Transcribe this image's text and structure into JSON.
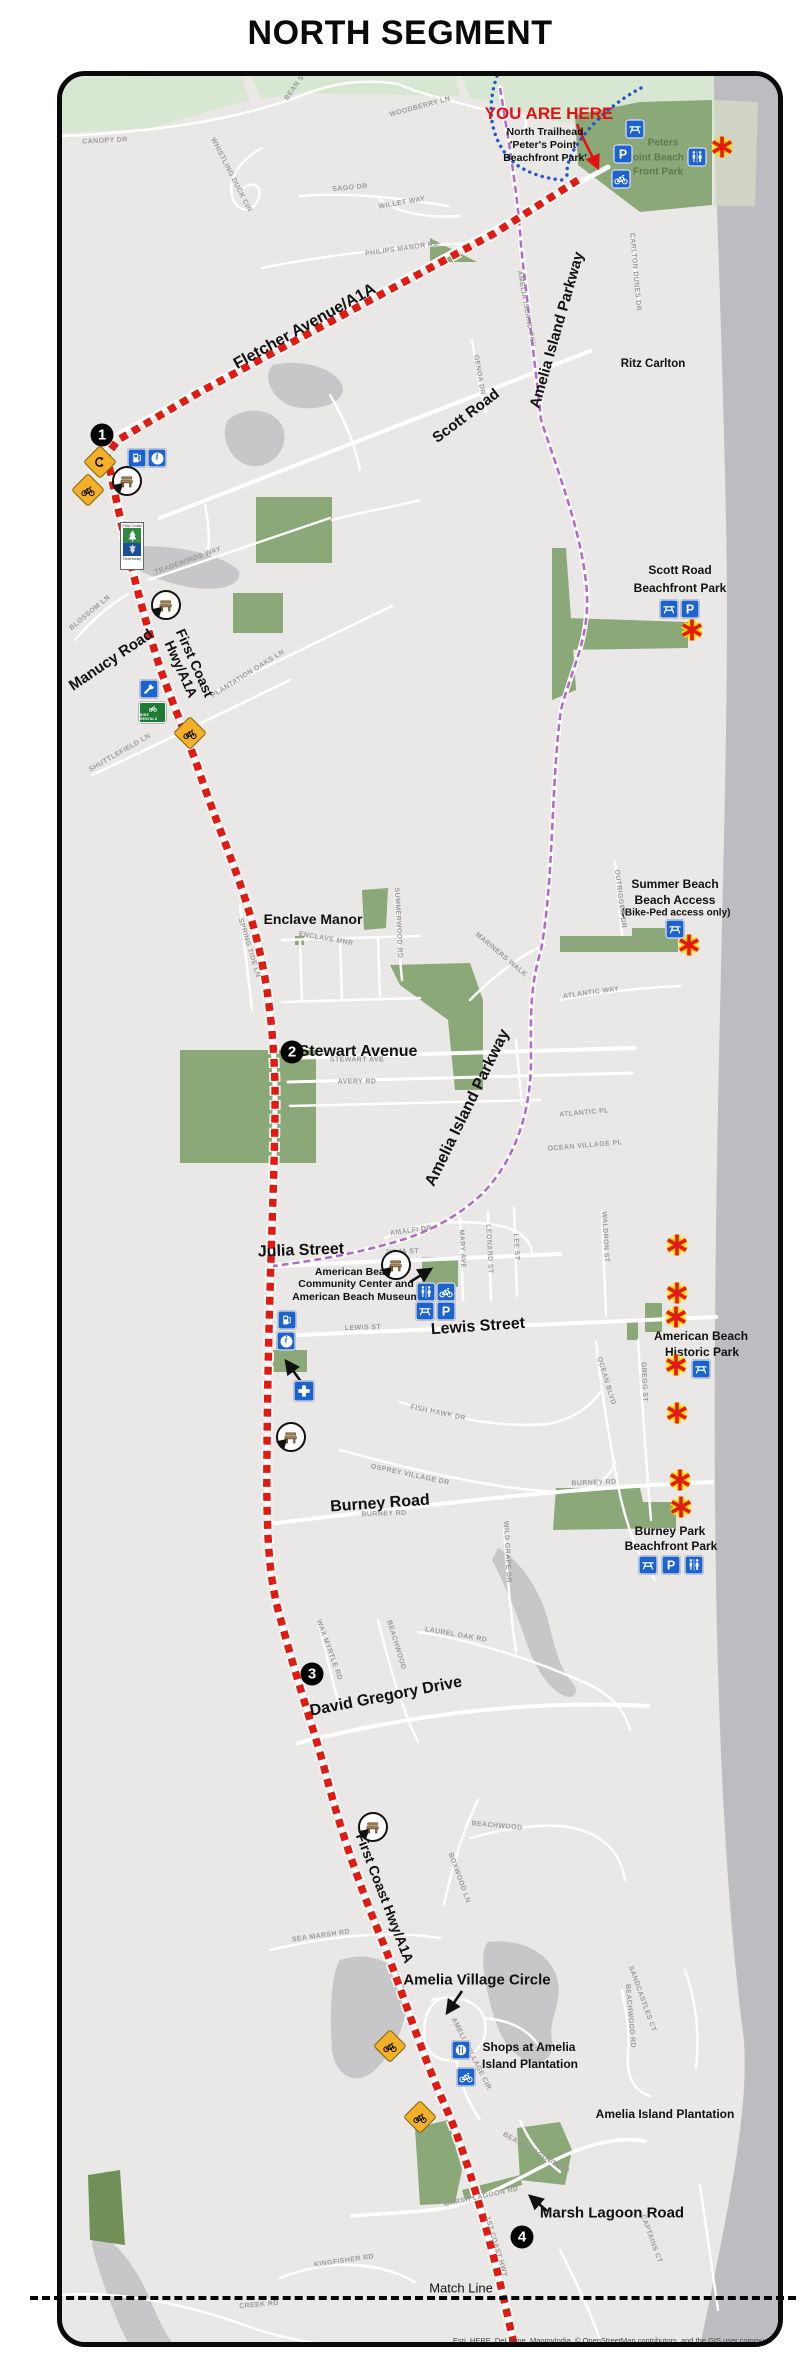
{
  "title": "NORTH SEGMENT",
  "you_are_here": {
    "headline": "YOU ARE HERE",
    "line1": "North Trailhead",
    "line2": "'Peter's Point",
    "line3": "Beachfront Park'"
  },
  "markers": {
    "m1": "1",
    "m2": "2",
    "m3": "3",
    "m4": "4"
  },
  "road_labels": {
    "fletcher": "Fletcher Avenue/A1A",
    "amelia_pkwy_top": "Amelia Island Parkway",
    "amelia_pkwy_mid": "Amelia Island Parkway",
    "scott": "Scott Road",
    "manucy": "Manucy Road",
    "first_coast_upper_1": "First Coast",
    "first_coast_upper_2": "Hwy/A1A",
    "stewart": "Stewart Avenue",
    "julia": "Julia Street",
    "lewis": "Lewis Street",
    "burney": "Burney Road",
    "david_gregory": "David Gregory Drive",
    "first_coast_lower": "First Coast Hwy/A1A",
    "amelia_village": "Amelia Village Circle",
    "marsh_lagoon": "Marsh Lagoon Road",
    "match_line": "Match Line"
  },
  "places": {
    "peters_point": [
      "Peters",
      "Point Beach",
      "Front Park"
    ],
    "ritz": "Ritz Carlton",
    "scott_park": [
      "Scott Road",
      "Beachfront Park"
    ],
    "summer_beach": [
      "Summer Beach",
      "Beach Access",
      "(Bike-Ped access only)"
    ],
    "enclave": "Enclave Manor",
    "am_beach_cc": [
      "American Beach",
      "Community Center and",
      "American Beach Museum"
    ],
    "am_beach_hp": [
      "American Beach",
      "Historic Park"
    ],
    "burney_park": [
      "Burney Park",
      "Beachfront Park"
    ],
    "shops": [
      "Shops at Amelia",
      "Island Plantation"
    ],
    "aip": "Amelia Island Plantation"
  },
  "icons": {
    "parking_letter": "P",
    "info_letter": "i",
    "bike_rentals": "BIKE RENTALS",
    "greenway_top": "First Coast",
    "greenway_bottom": "Greenway"
  },
  "streets": [
    "CANOPY DR",
    "BEAN ST",
    "WOODBERRY LN",
    "WHISTLING DUCK CIR",
    "SAGO DR",
    "WILLET WAY",
    "PHILIPS MANOR RD",
    "GENOA DR",
    "AMELIA ISLAND PKY",
    "CARLTON DUNES DR",
    "TRADEWINDS WAY",
    "BLOSSOM LN",
    "PLANTATION OAKS LN",
    "SHUTTLEFIELD LN",
    "OUTRIGGER DR",
    "ATLANTIC WAY",
    "SPRING TIDE LN",
    "ENCLAVE MNR",
    "SUMMERWOOD RD",
    "MARINERS WALK",
    "STEWART AVE",
    "AVERY RD",
    "ATLANTIC PL",
    "OCEAN VILLAGE PL",
    "AMALFI DR",
    "JULIA ST",
    "MARY AVE",
    "LEONARD ST",
    "LEE ST",
    "LEWIS ST",
    "WALDRON ST",
    "OCEAN BLVD",
    "GREGG ST",
    "FISH HAWK DR",
    "OSPREY VILLAGE DR",
    "BURNEY RD",
    "BURNEY RD",
    "WILD GRAPE DR",
    "LAUREL OAK RD",
    "WAX MYRTLE RD",
    "BEACHWOOD",
    "BEACHWOOD",
    "BOXWOOD LN",
    "SEA MARSH RD",
    "AMELIA VILLAGE CIR",
    "SANDCASTLES CT",
    "BEACHWOOD RD",
    "MARSH LAGOON RD",
    "BEACH LAGOON RD",
    "1ST COAST HWY",
    "CAPTAINS CT",
    "KINGFISHER RD",
    "CREEK RD"
  ],
  "attribution": "Esri, HERE, DeLorme, MapmyIndia, © OpenStreetMap contributors, and the GIS user community",
  "colors": {
    "route_red": "#e21b12",
    "trail_purple": "#b46bc8",
    "access_blue": "#2255cc",
    "park_green": "#8aa878",
    "beach_gray": "#bdbdc1",
    "sign_yellow": "#f3b028",
    "icon_blue": "#1c63cf",
    "asterisk_halo": "#ffd800",
    "marker_black": "#000000"
  }
}
